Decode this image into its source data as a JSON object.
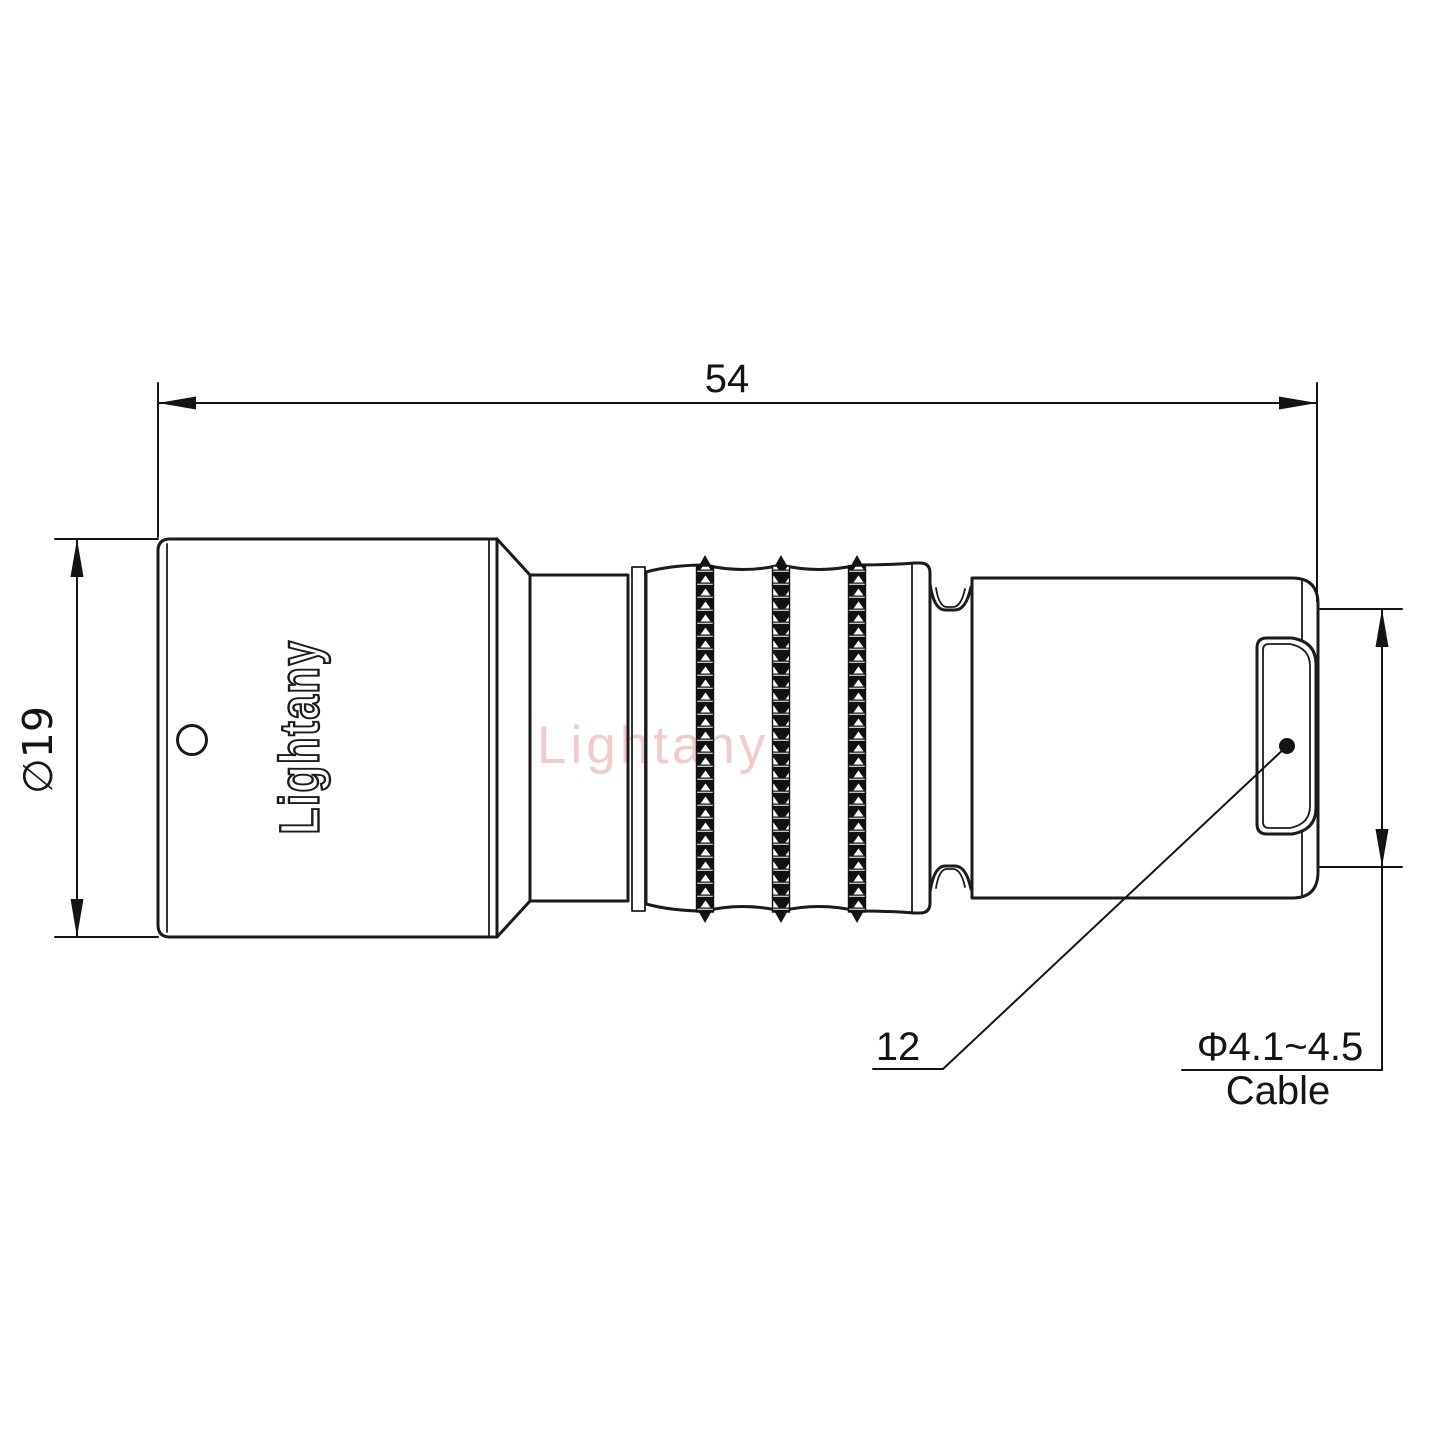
{
  "drawing": {
    "watermark": "Lightany",
    "engraving": "Lightany",
    "dims": {
      "overall_length": "54",
      "body_diameter": "∅19",
      "tail_diameter": "12",
      "cable_range": "Φ4.1~4.5",
      "cable_word": "Cable"
    },
    "colors": {
      "line": "#1b1b1b",
      "watermark": "#eec2c2",
      "background": "#ffffff"
    }
  }
}
